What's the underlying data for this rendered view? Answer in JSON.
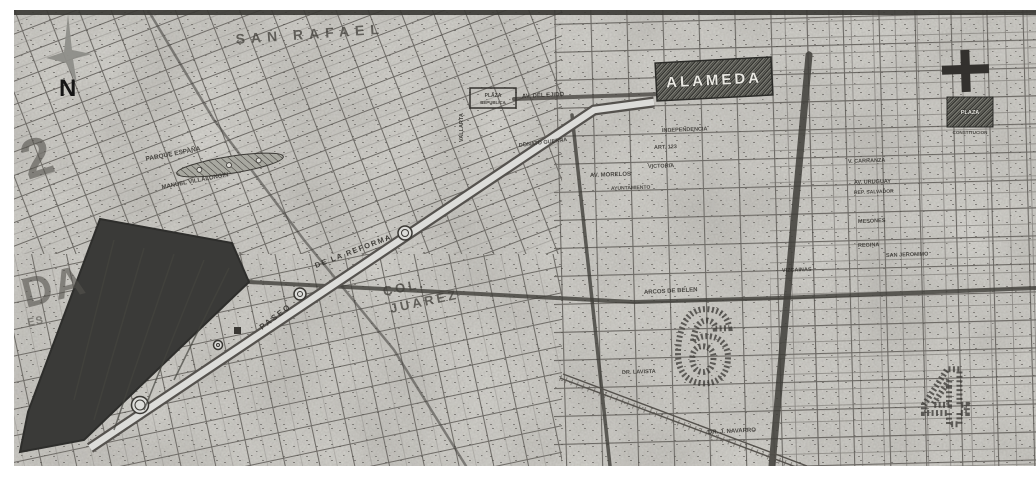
{
  "map": {
    "compass": {
      "north_label": "N"
    },
    "palette": {
      "paper": "#d9d8d3",
      "ink": "#2f2d2a",
      "dark_zone": "#3a3a38",
      "compass_gray": "#8e8e89",
      "park_hatch": "#7c7c74"
    },
    "landmarks": {
      "alameda": {
        "label": "ALAMEDA"
      },
      "plaza_constitucion": {
        "line1": "PLAZA",
        "line2": "CONSTITUCION"
      },
      "plaza_republica": {
        "line1": "PLAZA",
        "line2": "REPUBLICA"
      },
      "parque_espana": {
        "label": "PARQUE ESPAÑA"
      }
    },
    "district_numbers": {
      "six": "6",
      "four": "4"
    },
    "big_labels": [
      {
        "t": "SAN RAFAEL",
        "x": 222,
        "y": 34,
        "r": -4,
        "s": 14,
        "ls": 6,
        "c": "big",
        "n": "colonia-label-san-rafael"
      },
      {
        "t": "COL.",
        "x": 370,
        "y": 286,
        "r": -12,
        "s": 13,
        "ls": 3,
        "c": "big",
        "n": "colonia-label-col"
      },
      {
        "t": "JUAREZ",
        "x": 377,
        "y": 303,
        "r": -12,
        "s": 13,
        "ls": 3,
        "c": "big",
        "n": "colonia-label-juarez"
      },
      {
        "t": "PASEO",
        "x": 248,
        "y": 320,
        "r": -37,
        "s": 8,
        "ls": 2,
        "c": "av",
        "n": "avenue-label-paseo"
      },
      {
        "t": "DE LA REFORMA",
        "x": 302,
        "y": 258,
        "r": -21,
        "s": 7.5,
        "ls": 1.5,
        "c": "av",
        "n": "avenue-label-reforma"
      },
      {
        "t": "DA",
        "x": 12,
        "y": 298,
        "r": -14,
        "s": 42,
        "ls": 2,
        "c": "ghost",
        "n": "edge-letters-da"
      },
      {
        "t": "ES",
        "x": 14,
        "y": 316,
        "r": -10,
        "s": 11,
        "ls": 1,
        "c": "ghost",
        "n": "edge-letters-es"
      },
      {
        "t": "2",
        "x": 14,
        "y": 170,
        "r": -18,
        "s": 55,
        "ls": 0,
        "c": "ghost",
        "n": "edge-numeral-2"
      },
      {
        "t": "6",
        "x": 686,
        "y": 372,
        "r": 6,
        "s": 105,
        "ls": 0,
        "c": "outline",
        "n": "district-numeral-6"
      },
      {
        "t": "4",
        "x": 931,
        "y": 414,
        "r": 0,
        "s": 80,
        "ls": 0,
        "c": "outline",
        "n": "district-numeral-4"
      }
    ],
    "street_labels": [
      {
        "t": "MANUEL VILLALONGIN",
        "x": 148,
        "y": 179,
        "r": -11,
        "s": 6,
        "n": "street-label"
      },
      {
        "t": "PARQUE ESPAÑA",
        "x": 132,
        "y": 151,
        "r": -11,
        "s": 6.5,
        "n": "park-label"
      },
      {
        "t": "DONATO GUERRA",
        "x": 505,
        "y": 137,
        "r": -7,
        "s": 5.5,
        "n": "street-label"
      },
      {
        "t": "VALLARTA",
        "x": 449,
        "y": 132,
        "r": -90,
        "s": 5.5,
        "n": "street-label"
      },
      {
        "t": "AV. DEL EJIDO",
        "x": 508,
        "y": 88,
        "r": -3,
        "s": 6,
        "n": "street-label"
      },
      {
        "t": "AV. MORELOS",
        "x": 576,
        "y": 167,
        "r": -2,
        "s": 6,
        "n": "street-label"
      },
      {
        "t": "INDEPENDENCIA",
        "x": 648,
        "y": 122,
        "r": -2,
        "s": 5.5,
        "n": "street-label"
      },
      {
        "t": "ART. 123",
        "x": 640,
        "y": 139,
        "r": -2,
        "s": 5.5,
        "n": "street-label"
      },
      {
        "t": "VICTORIA",
        "x": 634,
        "y": 158,
        "r": -2,
        "s": 5.5,
        "n": "street-label"
      },
      {
        "t": "AYUNTAMIENTO",
        "x": 597,
        "y": 180,
        "r": -2,
        "s": 5,
        "n": "street-label"
      },
      {
        "t": "ARCOS DE BELEN",
        "x": 630,
        "y": 284,
        "r": -3,
        "s": 6,
        "n": "street-label"
      },
      {
        "t": "VIZCAINAS",
        "x": 768,
        "y": 262,
        "r": -2,
        "s": 5.5,
        "n": "street-label"
      },
      {
        "t": "V. CARRANZA",
        "x": 834,
        "y": 153,
        "r": -2,
        "s": 5.5,
        "n": "street-label"
      },
      {
        "t": "AV. URUGUAY",
        "x": 840,
        "y": 174,
        "r": -2,
        "s": 5.5,
        "n": "street-label"
      },
      {
        "t": "REP. SALVADOR",
        "x": 840,
        "y": 184,
        "r": -2,
        "s": 5,
        "n": "street-label"
      },
      {
        "t": "MESONES",
        "x": 844,
        "y": 213,
        "r": -2,
        "s": 5.5,
        "n": "street-label"
      },
      {
        "t": "REGINA",
        "x": 844,
        "y": 237,
        "r": -2,
        "s": 5.5,
        "n": "street-label"
      },
      {
        "t": "SAN JERONIMO",
        "x": 872,
        "y": 247,
        "r": -2,
        "s": 5.5,
        "n": "street-label"
      },
      {
        "t": "DR. LAVISTA",
        "x": 608,
        "y": 364,
        "r": -2,
        "s": 5.5,
        "n": "street-label"
      },
      {
        "t": "DR. J. NAVARRO",
        "x": 694,
        "y": 424,
        "r": -3,
        "s": 6,
        "n": "street-label"
      }
    ],
    "reforma": {
      "glorietas": [
        {
          "x": 391,
          "y": 223,
          "rr": 7
        },
        {
          "x": 286,
          "y": 284,
          "rr": 6
        },
        {
          "x": 204,
          "y": 335,
          "rr": 4.5
        },
        {
          "x": 126,
          "y": 395,
          "rr": 8.5
        }
      ]
    }
  }
}
